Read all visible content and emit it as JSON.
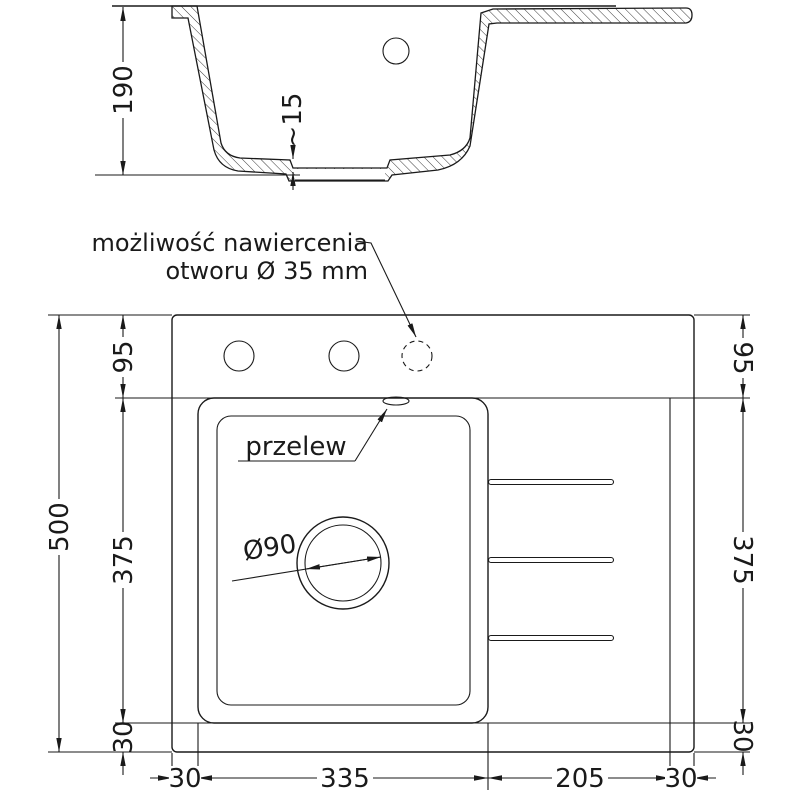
{
  "colors": {
    "line": "#1a1a1a",
    "bg": "#ffffff"
  },
  "section": {
    "depth": "190",
    "drain_step": "~15"
  },
  "plan": {
    "note_line1": "możliwość nawiercenia",
    "note_line2": "otworu Ø 35 mm",
    "overflow": "przelew",
    "drain_diameter": "Ø90"
  },
  "dims": {
    "left": {
      "total": "500",
      "deck": "95",
      "bowl": "375",
      "margin": "30"
    },
    "right": {
      "deck": "95",
      "bowl": "375",
      "margin": "30"
    },
    "bottom": {
      "left_margin": "30",
      "bowl": "335",
      "drainer": "205",
      "right_margin": "30"
    }
  }
}
